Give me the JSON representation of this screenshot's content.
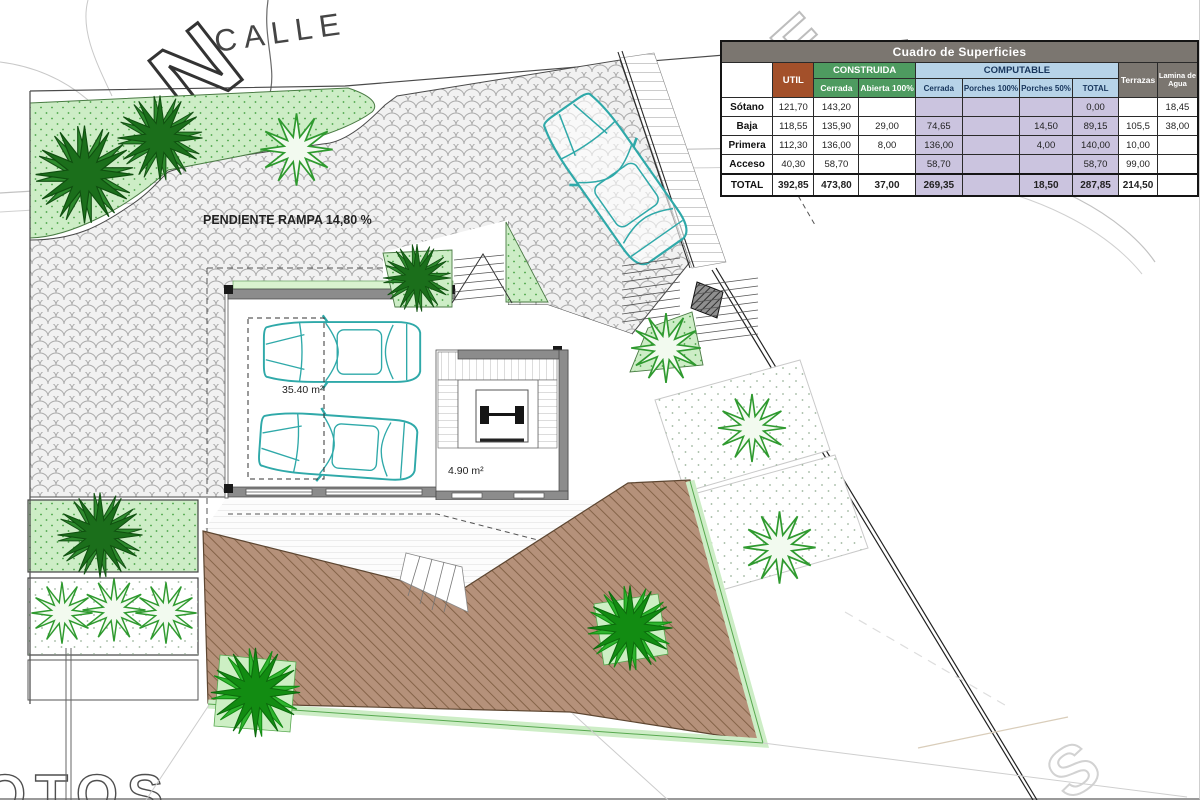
{
  "plan": {
    "north_label": "N",
    "street_label": "CALLE",
    "ramp_label": "PENDIENTE RAMPA 14,80 %",
    "garage_area_label": "35.40 m²",
    "stair_area_label": "4.90 m²",
    "watermarks": {
      "top": "E",
      "bottom_right": "S",
      "bottom_left": "OTOS"
    },
    "colors": {
      "car_teal": "#2FA9A9",
      "deck_brown": "#B5917A",
      "deck_stripe": "#7F5E42",
      "bed_green": "#CDEDC6",
      "palm_dark_green": "#1B6F1B",
      "palm_bright_green": "#2FB52F",
      "paver_grey": "#ABABAB",
      "wall_grey": "#8C8C8C"
    }
  },
  "table": {
    "title": "Cuadro de Superficies",
    "col_groups": {
      "util": "UTIL",
      "construida": "CONSTRUIDA",
      "computable": "COMPUTABLE",
      "terrazas": "Terrazas",
      "lamina_line1": "Lamina de",
      "lamina_line2": "Agua"
    },
    "sub": {
      "construida": [
        "Cerrada",
        "Abierta 100%"
      ],
      "computable": [
        "Cerrada",
        "Porches 100%",
        "Porches 50%",
        "TOTAL"
      ]
    },
    "colors": {
      "title_grey": "#7B7670",
      "util_brown": "#A3502A",
      "construida_green": "#4E9B60",
      "computable_blue": "#B7D3E8",
      "computable_cell_lavender": "#CBC4DF"
    },
    "rows": [
      {
        "label": "Sótano",
        "total": false,
        "cells": [
          "121,70",
          "143,20",
          "",
          "",
          "",
          "",
          "0,00",
          "",
          "18,45"
        ]
      },
      {
        "label": "Baja",
        "total": false,
        "cells": [
          "118,55",
          "135,90",
          "29,00",
          "74,65",
          "",
          "14,50",
          "89,15",
          "105,5",
          "38,00"
        ]
      },
      {
        "label": "Primera",
        "total": false,
        "cells": [
          "112,30",
          "136,00",
          "8,00",
          "136,00",
          "",
          "4,00",
          "140,00",
          "10,00",
          ""
        ]
      },
      {
        "label": "Acceso",
        "total": false,
        "cells": [
          "40,30",
          "58,70",
          "",
          "58,70",
          "",
          "",
          "58,70",
          "99,00",
          ""
        ]
      },
      {
        "label": "TOTAL",
        "total": true,
        "cells": [
          "392,85",
          "473,80",
          "37,00",
          "269,35",
          "",
          "18,50",
          "287,85",
          "214,50",
          ""
        ]
      }
    ]
  }
}
